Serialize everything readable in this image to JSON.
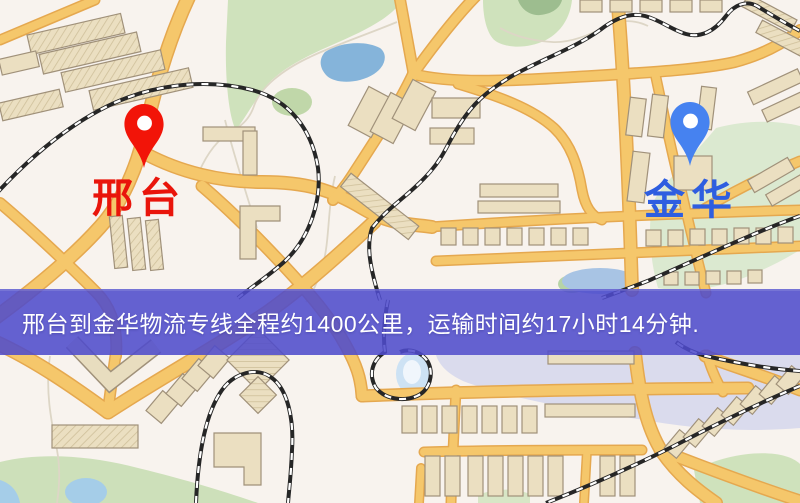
{
  "banner": {
    "text": "邢台到金华物流专线全程约1400公里，运输时间约17小时14分钟.",
    "background_color": "#4e4bcb",
    "text_color": "#ffffff"
  },
  "markers": {
    "origin": {
      "label": "邢台",
      "pin_color": "#f21408",
      "label_color": "#e9150b"
    },
    "destination": {
      "label": "金华",
      "pin_color": "#4682f0",
      "label_color": "#2e5ee0"
    }
  },
  "map_palette": {
    "background": "#f8f3ee",
    "road_fill": "#f5c76b",
    "road_casing": "#e5a84f",
    "building_fill": "#ebdfc1",
    "building_outline": "#a0917a",
    "park_green": "#cfe2bc",
    "water_blue": "#85b4da",
    "railway_black": "#262626"
  }
}
